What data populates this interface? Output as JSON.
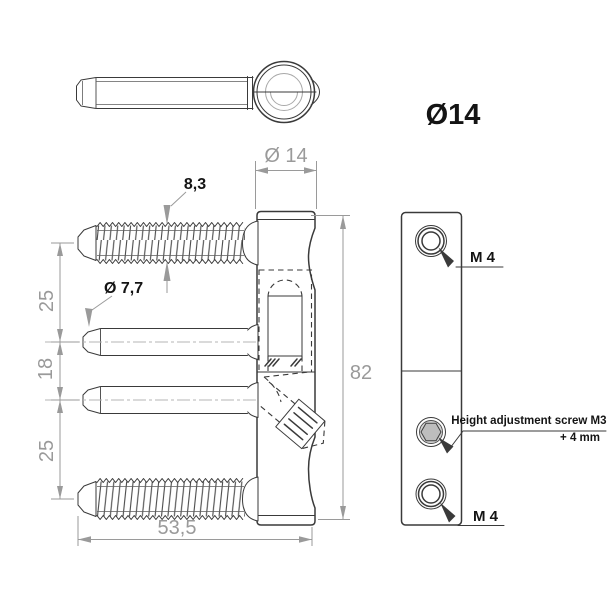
{
  "drawing": {
    "title": "Ø14",
    "front_view": {
      "thread_od_label": "8,3",
      "pin_od_label": "Ø 7,7",
      "column_od_label": "Ø 14",
      "pitch_top_label": "25",
      "pitch_mid_label": "18",
      "pitch_bottom_label": "25",
      "length_label": "53,5",
      "height_label": "82"
    },
    "side_view": {
      "hole_top_label": "M 4",
      "hole_bottom_label": "M 4",
      "adjust_screw_label_line1": "Height adjustment screw M3",
      "adjust_screw_label_line2": "+ 4 mm"
    },
    "colors": {
      "line": "#3a3a3a",
      "dim": "#9a9a9a",
      "label": "#141414",
      "screw_fill": "#bdbdbd"
    }
  }
}
